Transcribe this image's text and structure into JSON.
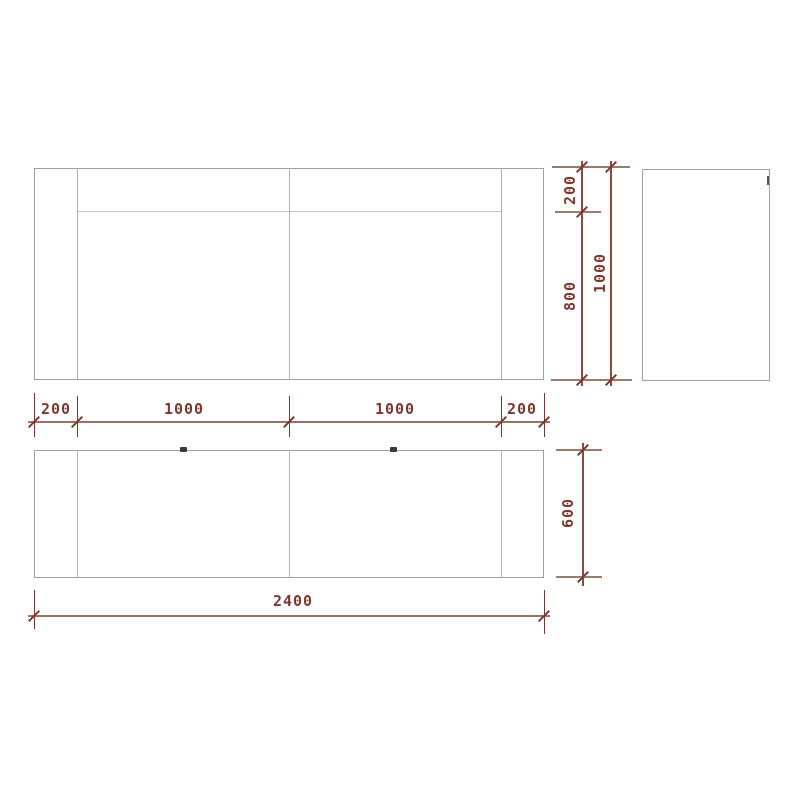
{
  "drawing": {
    "type": "technical-dimension-drawing",
    "background": "#ffffff",
    "object_line_color": "#a0a0a0",
    "dimension_color": "#7a392e",
    "views": {
      "front": {
        "width_mm": 2400,
        "height_mm": 1000
      },
      "side": {
        "width_mm": 600,
        "height_mm": 1000
      },
      "plan": {
        "width_mm": 2400,
        "depth_mm": 600
      }
    }
  },
  "dims": {
    "width_segments": [
      "200",
      "1000",
      "1000",
      "200"
    ],
    "total_width": "2400",
    "height_segments": [
      "200",
      "800"
    ],
    "total_height": "1000",
    "depth": "600"
  }
}
